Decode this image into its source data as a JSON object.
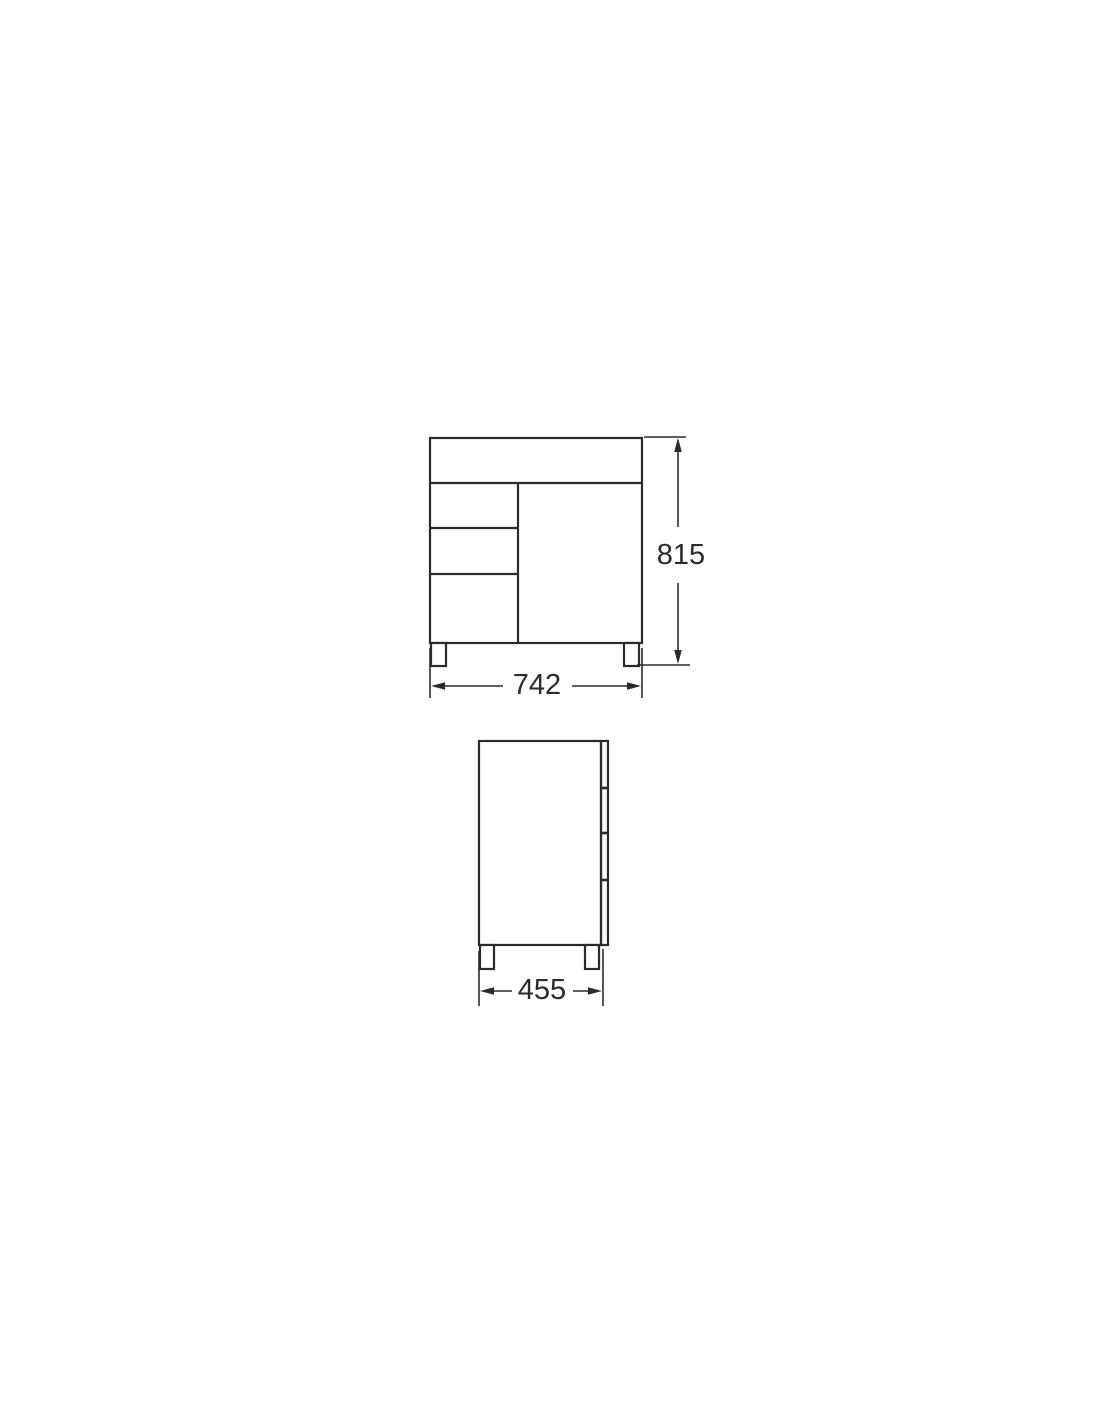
{
  "drawing": {
    "type": "technical-dimension-drawing",
    "background": "#ffffff",
    "line_color": "#2b2b2b",
    "front_view": {
      "height_label": "815",
      "width_label": "742"
    },
    "side_view": {
      "depth_label": "455"
    }
  }
}
